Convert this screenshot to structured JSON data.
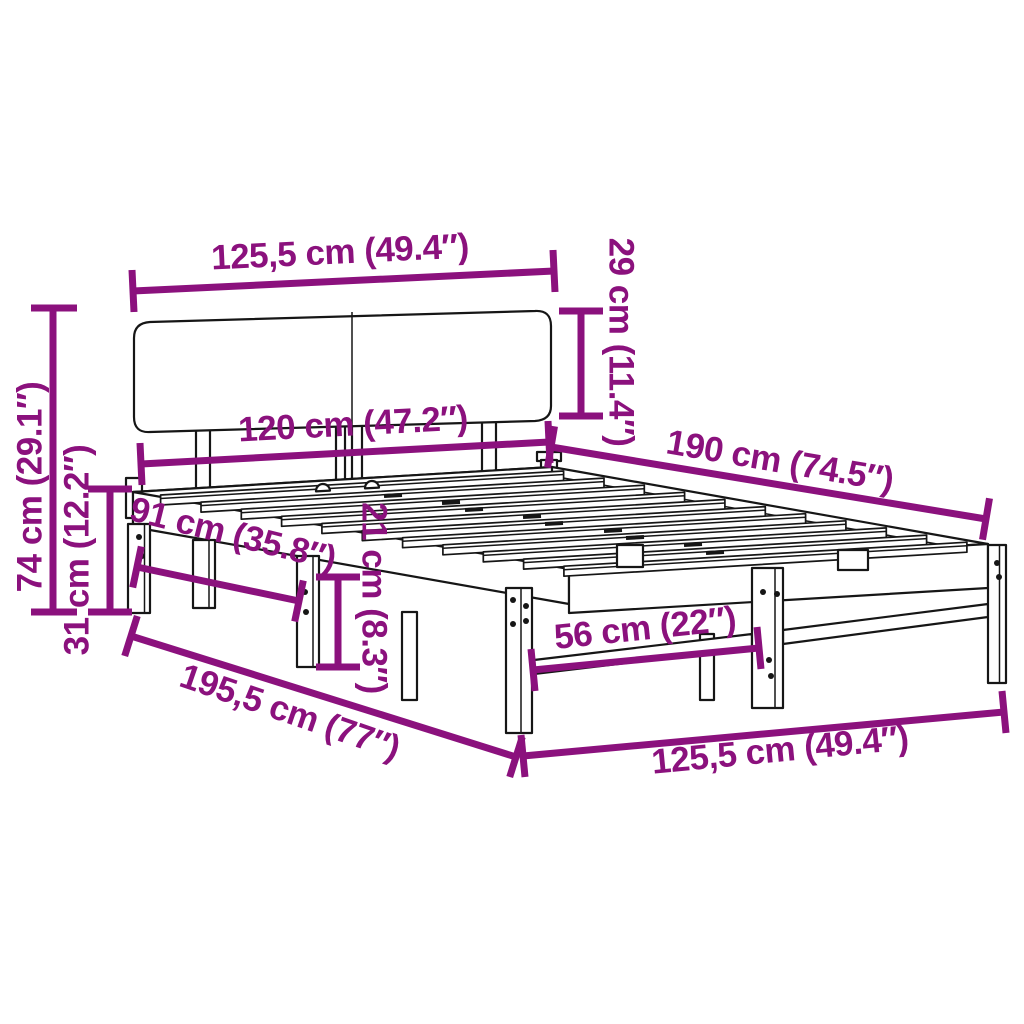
{
  "page": {
    "background_color": "#ffffff"
  },
  "diagram": {
    "subject": "wooden bed frame with headboard — product dimension diagram",
    "accent_color": "#8B117D",
    "outline_color": "#161616",
    "dimensions": [
      {
        "id": "headboard-width",
        "label": "125,5 cm (49.4″)"
      },
      {
        "id": "headboard-height",
        "label": "29 cm (11.4″)"
      },
      {
        "id": "total-height",
        "label": "74 cm (29.1″)"
      },
      {
        "id": "base-height",
        "label": "31 cm (12.2″)"
      },
      {
        "id": "slat-area-width",
        "label": "120 cm (47.2″)"
      },
      {
        "id": "sleeping-length",
        "label": "190 cm (74.5″)"
      },
      {
        "id": "side-leg-spacing",
        "label": "91 cm (35.8″)"
      },
      {
        "id": "under-bed-clearance",
        "label": "21 cm (8.3″)"
      },
      {
        "id": "foot-leg-spacing",
        "label": "56 cm (22″)"
      },
      {
        "id": "total-length",
        "label": "195,5 cm (77″)"
      },
      {
        "id": "total-width",
        "label": "125,5 cm (49.4″)"
      }
    ]
  }
}
